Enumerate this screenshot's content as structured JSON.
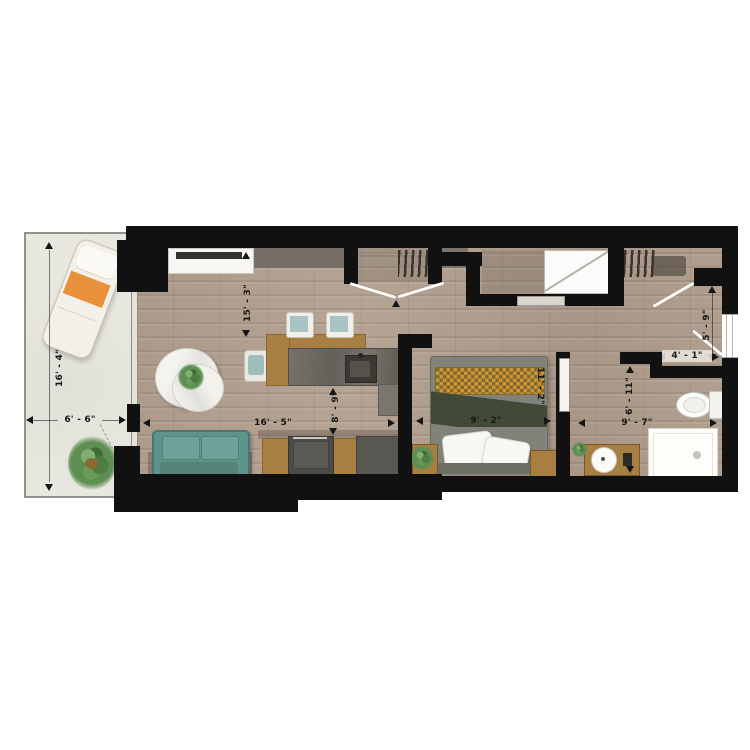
{
  "colors": {
    "wall": "#111111",
    "floor": "#b3a192",
    "balcony": "#e9e8e0",
    "sofa": "#5f948b",
    "orange": "#e8913a",
    "wood": "#a87f42",
    "stone": "#6f6b63",
    "duvet": "#81837a",
    "fold": "#414a36",
    "chk1": "#d2952f",
    "chk2": "#7e6a33",
    "white": "#f7f6f2"
  },
  "dims": {
    "balcony_h": "16' - 4\"",
    "balcony_w": "6' - 6\"",
    "living_h": "15' - 3\"",
    "living_w": "16' - 5\"",
    "kitchen_d": "8' - 9\"",
    "bedroom_w": "9' - 2\"",
    "bedroom_h": "11' - 2\"",
    "hall_h": "5' - 9\"",
    "hall_w": "4' - 1\"",
    "bath_h": "6' - 11\"",
    "bath_w": "9' - 7\""
  }
}
